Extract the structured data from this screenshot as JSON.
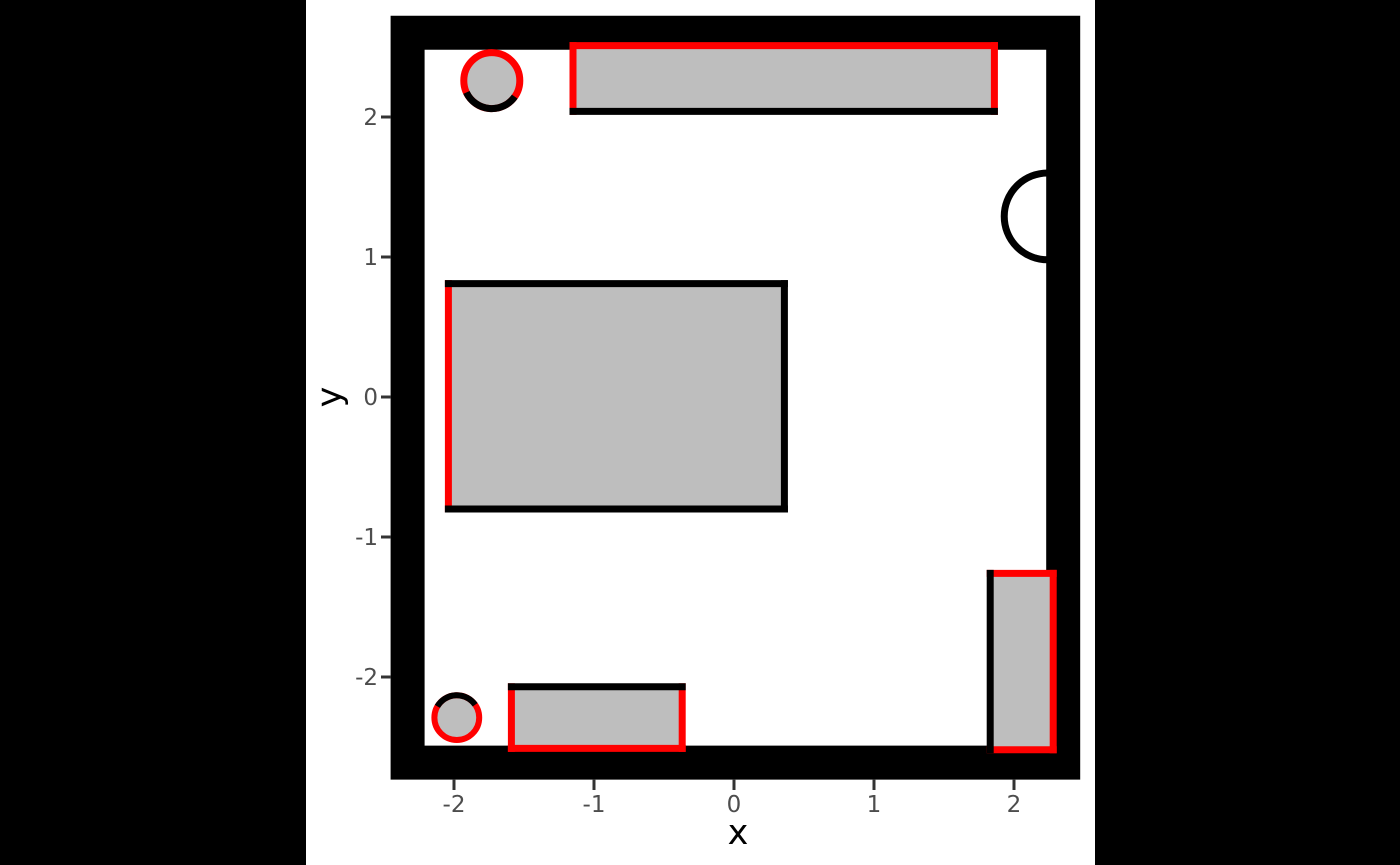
{
  "style": {
    "background": "#000000",
    "figure_bg": "#ffffff",
    "wall_color": "#000000",
    "object_fill": "#bebebe",
    "accent_red": "#ff0000",
    "tick_label_color": "#4d4d4d",
    "tick_mark_color": "#333333",
    "axis_label_color": "#000000"
  },
  "chart_data": {
    "type": "floorplan",
    "title": "",
    "xlabel": "x",
    "ylabel": "y",
    "x_tick_values": [
      -2,
      -1,
      0,
      1,
      2
    ],
    "x_tick_labels": [
      "-2",
      "-1",
      "0",
      "1",
      "2"
    ],
    "y_tick_values": [
      2,
      1,
      0,
      -1,
      -2
    ],
    "y_tick_labels": [
      "2",
      "1",
      "0",
      "-1",
      "-2"
    ],
    "grid": false,
    "legend": false,
    "room": {
      "inner_x": [
        -2.21,
        2.23
      ],
      "inner_y": [
        -2.49,
        2.48
      ],
      "wall_thickness_px": 34,
      "wall_color": "#000000"
    },
    "door": {
      "cx": 2.24,
      "cy": 1.29,
      "r": 0.31,
      "open_side": "left",
      "color": "#000000",
      "stroke_px": 7
    },
    "furniture": [
      {
        "name": "long-table-top-wall",
        "x": [
          -1.15,
          1.86
        ],
        "y": [
          2.04,
          2.51
        ],
        "fill": "#bebebe",
        "edge_width_px": 7,
        "edges": {
          "top": "#ff0000",
          "right": "#ff0000",
          "bottom": "#000000",
          "left": "#ff0000"
        }
      },
      {
        "name": "large-table-center-left",
        "x": [
          -2.04,
          0.36
        ],
        "y": [
          -0.8,
          0.81
        ],
        "fill": "#bebebe",
        "edge_width_px": 7,
        "edges": {
          "top": "#000000",
          "right": "#000000",
          "bottom": "#000000",
          "left": "#ff0000"
        }
      },
      {
        "name": "small-table-bottom-wall",
        "x": [
          -1.59,
          -0.37
        ],
        "y": [
          -2.51,
          -2.07
        ],
        "fill": "#bebebe",
        "edge_width_px": 7,
        "edges": {
          "top": "#000000",
          "right": "#ff0000",
          "bottom": "#ff0000",
          "left": "#ff0000"
        }
      },
      {
        "name": "tall-cabinet-right-wall",
        "x": [
          1.83,
          2.28
        ],
        "y": [
          -2.52,
          -1.26
        ],
        "fill": "#bebebe",
        "edge_width_px": 7,
        "edges": {
          "top": "#ff0000",
          "right": "#ff0000",
          "bottom": "#ff0000",
          "left": "#000000"
        }
      }
    ],
    "round_objects": [
      {
        "name": "round-object-top-left",
        "cx": -1.73,
        "cy": 2.26,
        "r": 0.2,
        "fill": "#bebebe",
        "ring_color": "#ff0000",
        "ring_width_px": 7,
        "arc_color": "#000000",
        "arc_start_deg": 205,
        "arc_end_deg": 325
      },
      {
        "name": "round-object-bottom-left",
        "cx": -1.98,
        "cy": -2.29,
        "r": 0.16,
        "fill": "#bebebe",
        "ring_color": "#ff0000",
        "ring_width_px": 6,
        "arc_color": "#000000",
        "arc_start_deg": 35,
        "arc_end_deg": 150
      }
    ],
    "layout": {
      "origin_x_px": 734,
      "origin_y_px": 397,
      "px_per_unit": 140,
      "figure_left_px": 306,
      "figure_width_px": 789,
      "x_tick_y1_px": 779,
      "x_tick_y2_px": 790,
      "x_tick_label_baseline_px": 812,
      "y_tick_x1_px": 381,
      "y_tick_x2_px": 391,
      "y_tick_label_right_px": 378,
      "tick_stroke_px": 3,
      "tick_font_px": 23
    }
  }
}
